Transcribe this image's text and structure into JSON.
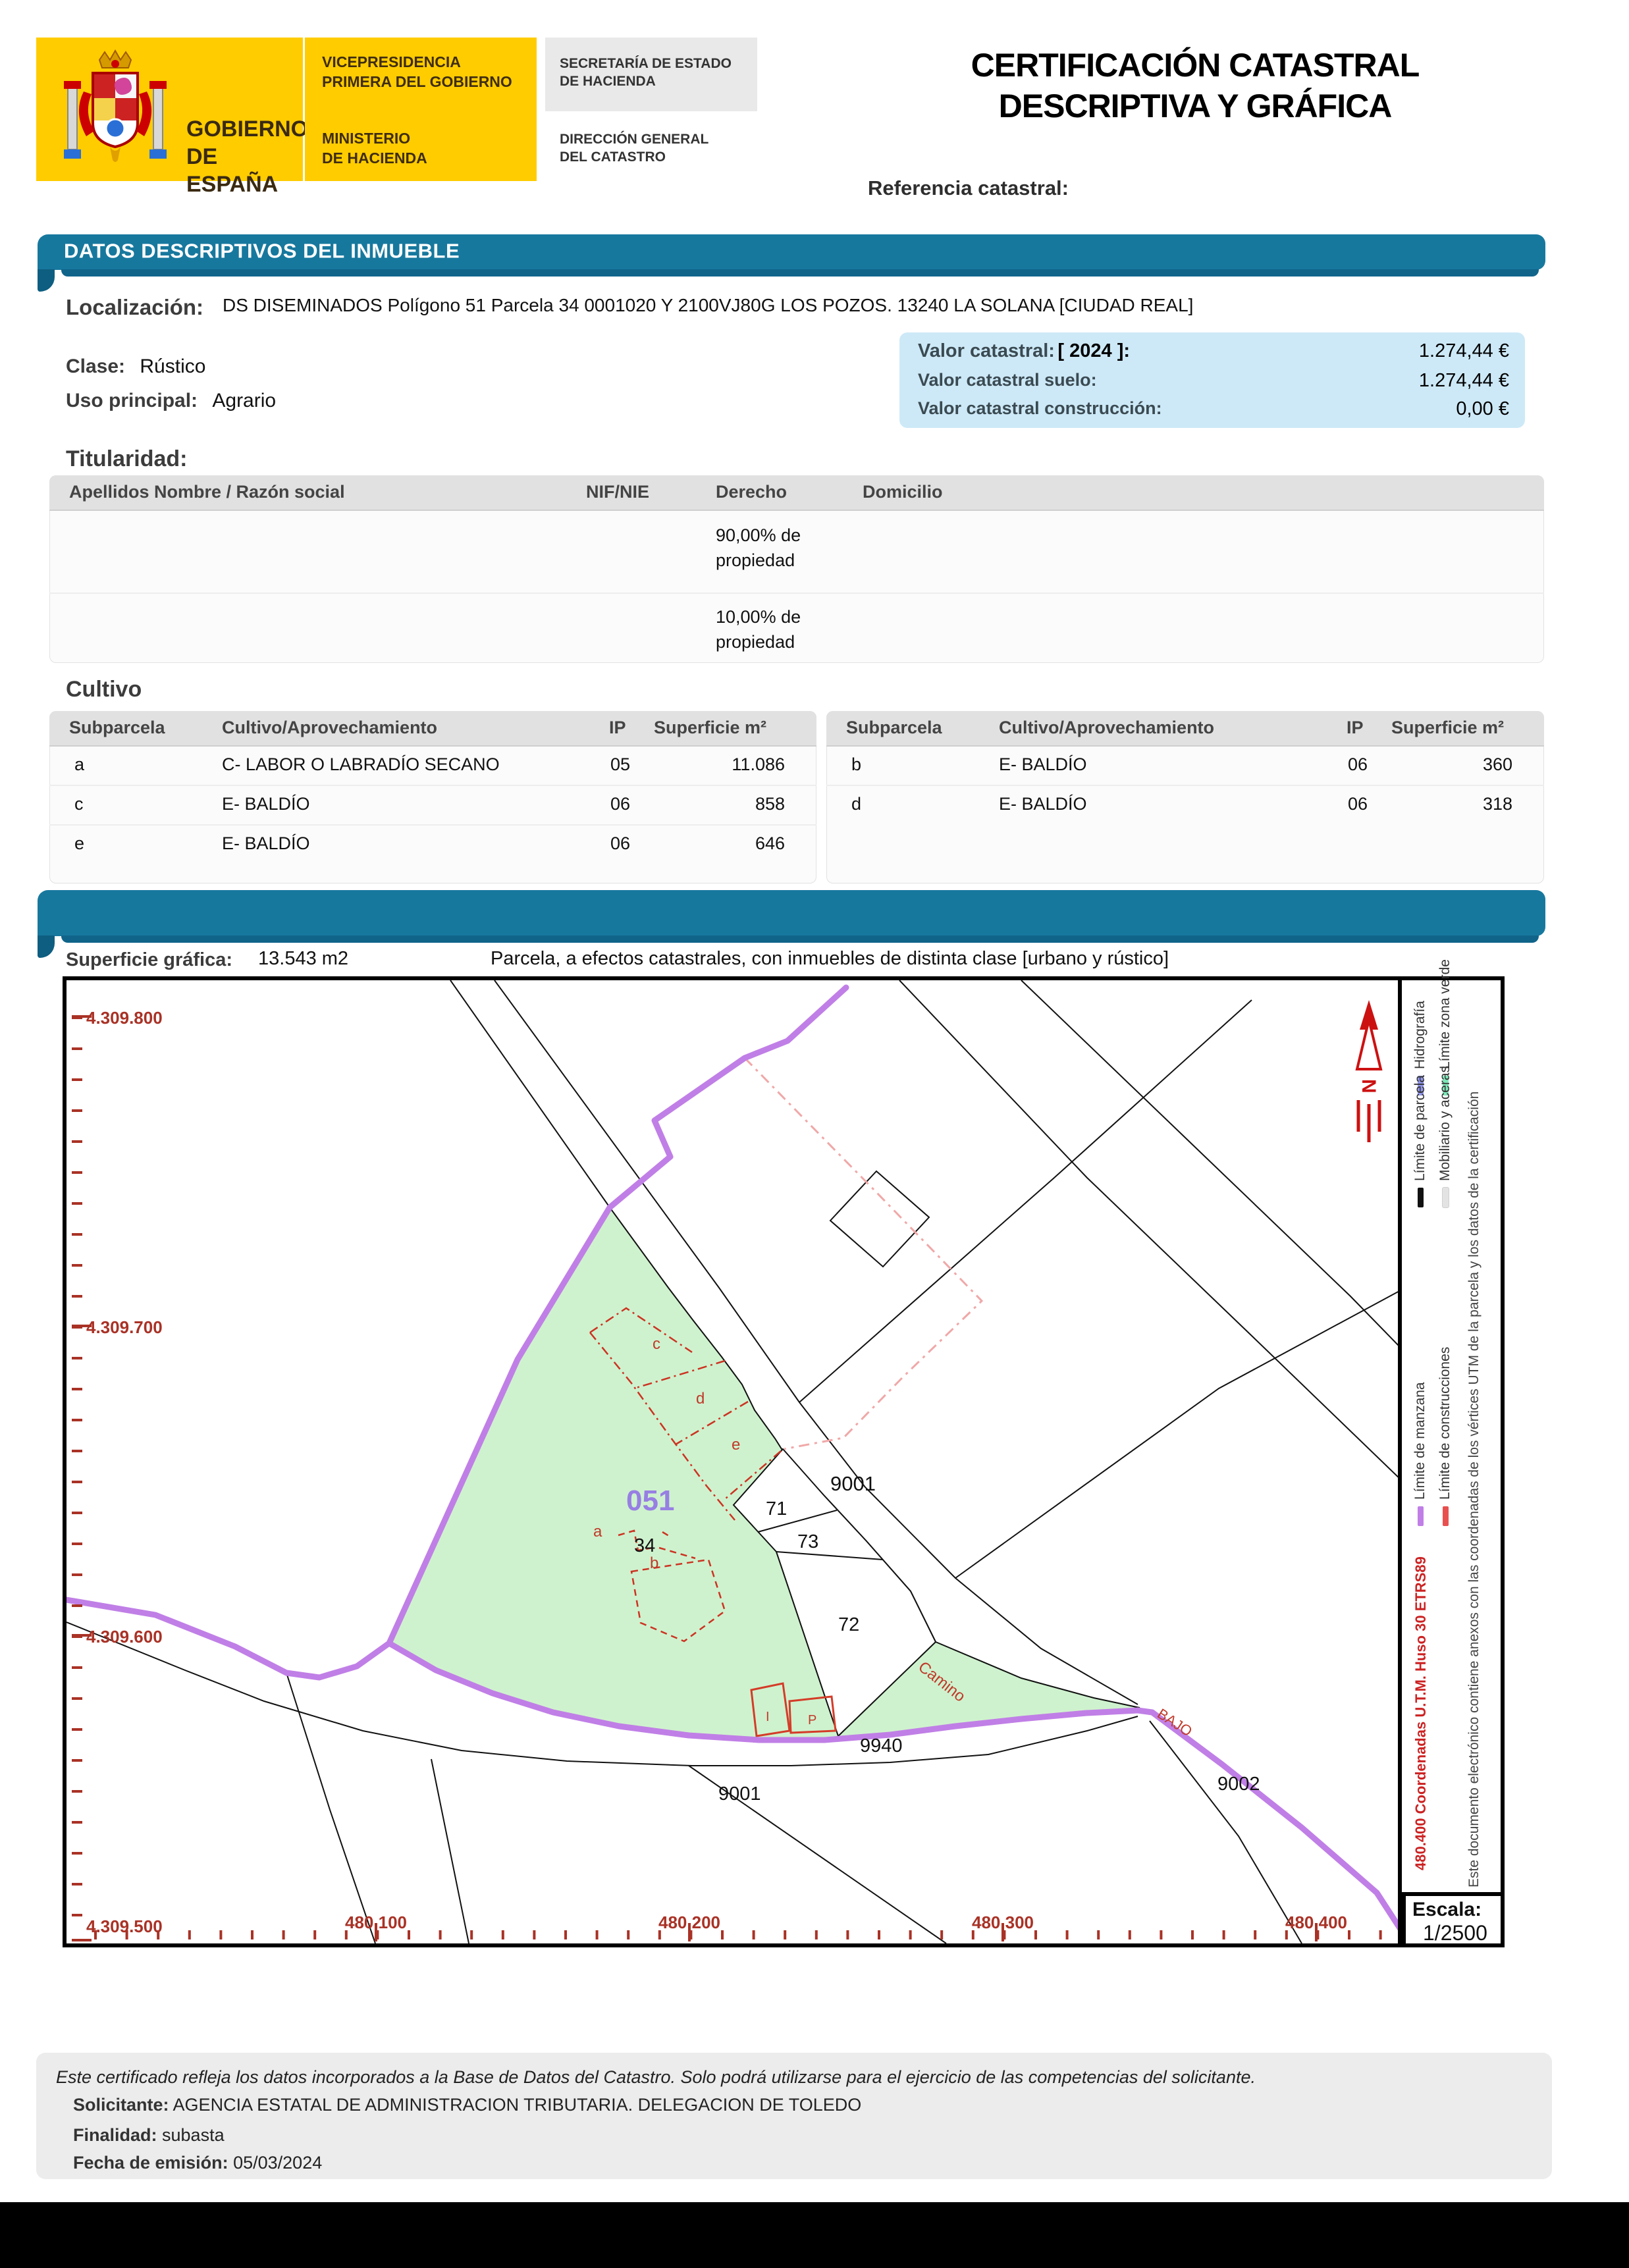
{
  "header": {
    "logo": {
      "gobierno_line1": "GOBIERNO",
      "gobierno_line2": "DE ESPAÑA",
      "vice_line1": "VICEPRESIDENCIA",
      "vice_line2": "PRIMERA DEL GOBIERNO",
      "min_line1": "MINISTERIO",
      "min_line2": "DE HACIENDA",
      "sec_line1": "SECRETARÍA DE ESTADO",
      "sec_line2": "DE HACIENDA",
      "dg_line1": "DIRECCIÓN GENERAL",
      "dg_line2": "DEL CATASTRO"
    },
    "title_line1": "CERTIFICACIÓN CATASTRAL",
    "title_line2": "DESCRIPTIVA Y GRÁFICA",
    "referencia_label": "Referencia catastral:"
  },
  "descriptivos": {
    "banner": "DATOS DESCRIPTIVOS DEL INMUEBLE",
    "localizacion_label": "Localización:",
    "localizacion_value": "DS DISEMINADOS  Polígono 51 Parcela 34 0001020 Y 2100VJ80G LOS POZOS. 13240 LA SOLANA [CIUDAD REAL]",
    "clase_label": "Clase:",
    "clase_value": "Rústico",
    "uso_label": "Uso principal:",
    "uso_value": "Agrario",
    "valor": {
      "l1": "Valor catastral:",
      "l1_year": "[ 2024 ]:",
      "v1": "1.274,44 €",
      "l2": "Valor catastral suelo:",
      "v2": "1.274,44 €",
      "l3": "Valor catastral construcción:",
      "v3": "0,00 €"
    }
  },
  "titularidad": {
    "heading": "Titularidad:",
    "col_nombre": "Apellidos Nombre / Razón social",
    "col_nif": "NIF/NIE",
    "col_derecho": "Derecho",
    "col_domicilio": "Domicilio",
    "row1_derecho_l1": "90,00% de",
    "row1_derecho_l2": "propiedad",
    "row2_derecho_l1": "10,00% de",
    "row2_derecho_l2": "propiedad"
  },
  "cultivo": {
    "heading": "Cultivo",
    "cols": {
      "sub": "Subparcela",
      "cultivo": "Cultivo/Aprovechamiento",
      "ip": "IP",
      "sup": "Superficie m²"
    },
    "left_rows": [
      [
        "a",
        "C- LABOR O LABRADÍO  SECANO",
        "05",
        "11.086"
      ],
      [
        "c",
        "E- BALDÍO",
        "06",
        "858"
      ],
      [
        "e",
        "E- BALDÍO",
        "06",
        "646"
      ]
    ],
    "right_rows": [
      [
        "b",
        "E- BALDÍO",
        "06",
        "360"
      ],
      [
        "d",
        "E- BALDÍO",
        "06",
        "318"
      ]
    ]
  },
  "grafica": {
    "superficie_label": "Superficie gráfica:",
    "superficie_value": "13.543 m2",
    "parcela_note": "Parcela, a efectos catastrales, con inmuebles de distinta clase [urbano y rústico]",
    "y_labels": [
      "4.309.800",
      "4.309.700",
      "4.309.600",
      "4.309.500"
    ],
    "x_labels": [
      "480.100",
      "480.200",
      "480.300",
      "480.400"
    ],
    "north_letter": "N",
    "map_labels": {
      "manzana": "051",
      "parcela": "34",
      "road_top": "9001",
      "p71": "71",
      "p73": "73",
      "p72": "72",
      "p9940": "9940",
      "road_bottom": "9001",
      "p9002": "9002",
      "camino": "Camino",
      "bajo": "BAJO",
      "sub_a": "a",
      "sub_b": "b",
      "sub_c": "c",
      "sub_d": "d",
      "sub_e": "e",
      "constr_i": "I",
      "constr_p": "P"
    },
    "colors": {
      "parcel_green": "#cff2ce",
      "manzana_purple": "#c07fe6",
      "construction_red": "#d43c28",
      "axis_red": "#a93226",
      "certification_pink": "#f0a8a8"
    },
    "legend": {
      "items": [
        {
          "label": "Límite de parcela",
          "color": "#111111"
        },
        {
          "label": "Hidrografía",
          "color": "#9094e8"
        },
        {
          "label": "Límite zona verde",
          "color": "#7de8b8"
        },
        {
          "label": "Mobiliario y aceras",
          "color": "#e3e3e3"
        },
        {
          "label": "Límite de manzana",
          "color": "#c07fe6"
        },
        {
          "label": "Límite de construcciones",
          "color": "#e85050"
        }
      ],
      "coords_text": "480.400 Coordenadas U.T.M. Huso 30 ETRS89",
      "cert_text": "Este documento electrónico contiene anexos con las coordenadas de los vértices UTM de la parcela y los datos de la certificación",
      "escala_label": "Escala:",
      "escala_value": "1/2500"
    }
  },
  "footer": {
    "line1": "Este certificado refleja los datos incorporados a la Base de Datos del Catastro. Solo podrá utilizarse para el ejercicio de las competencias del solicitante.",
    "solicitante_label": "Solicitante:",
    "solicitante_value": "AGENCIA ESTATAL DE ADMINISTRACION TRIBUTARIA. DELEGACION DE TOLEDO",
    "finalidad_label": "Finalidad:",
    "finalidad_value": "subasta",
    "fecha_label": "Fecha de emisión:",
    "fecha_value": "05/03/2024"
  }
}
